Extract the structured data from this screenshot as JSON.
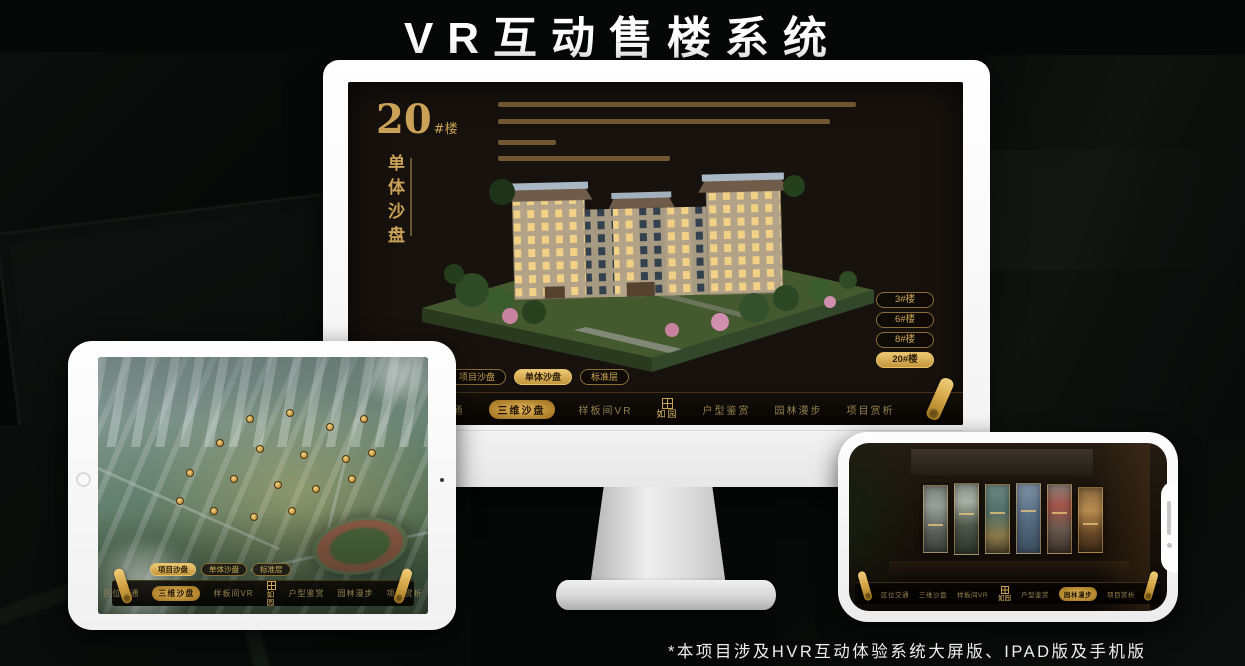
{
  "page": {
    "title": "VR互动售楼系统",
    "footnote": "*本项目涉及HVR互动体验系统大屏版、IPAD版及手机版"
  },
  "brand": {
    "logo_text": "如园"
  },
  "colors": {
    "gold": "#d9a94f",
    "gold_dark": "#8a6c35",
    "screen_bg": "#17120e",
    "highlight_text": "#2a1d08"
  },
  "monitor": {
    "block_number": "20",
    "block_suffix": "#楼",
    "vertical_title": "单体沙盘",
    "floor_buttons": [
      {
        "label": "3#楼",
        "active": false
      },
      {
        "label": "6#楼",
        "active": false
      },
      {
        "label": "8#楼",
        "active": false
      },
      {
        "label": "20#楼",
        "active": true
      }
    ],
    "tabs": [
      {
        "label": "项目沙盘",
        "active": false
      },
      {
        "label": "单体沙盘",
        "active": true
      },
      {
        "label": "标准层",
        "active": false
      }
    ],
    "nav_items": [
      {
        "label": "区位交通",
        "active": false
      },
      {
        "label": "三维沙盘",
        "active": true
      },
      {
        "label": "样板间VR",
        "active": false
      },
      {
        "label": "户型鉴赏",
        "active": false
      },
      {
        "label": "园林漫步",
        "active": false
      },
      {
        "label": "项目赏析",
        "active": false
      }
    ]
  },
  "tablet": {
    "tabs": [
      {
        "label": "项目沙盘",
        "active": true
      },
      {
        "label": "单体沙盘",
        "active": false
      },
      {
        "label": "标准层",
        "active": false
      }
    ],
    "nav_items": [
      {
        "label": "区位交通",
        "active": false
      },
      {
        "label": "三维沙盘",
        "active": true
      },
      {
        "label": "样板间VR",
        "active": false
      },
      {
        "label": "户型鉴赏",
        "active": false
      },
      {
        "label": "园林漫步",
        "active": false
      },
      {
        "label": "项目赏析",
        "active": false
      }
    ]
  },
  "phone": {
    "nav_items": [
      {
        "label": "区位交通",
        "active": false
      },
      {
        "label": "三维沙盘",
        "active": false
      },
      {
        "label": "样板间VR",
        "active": false
      },
      {
        "label": "户型鉴赏",
        "active": false
      },
      {
        "label": "园林漫步",
        "active": true
      },
      {
        "label": "项目赏析",
        "active": false
      }
    ]
  }
}
